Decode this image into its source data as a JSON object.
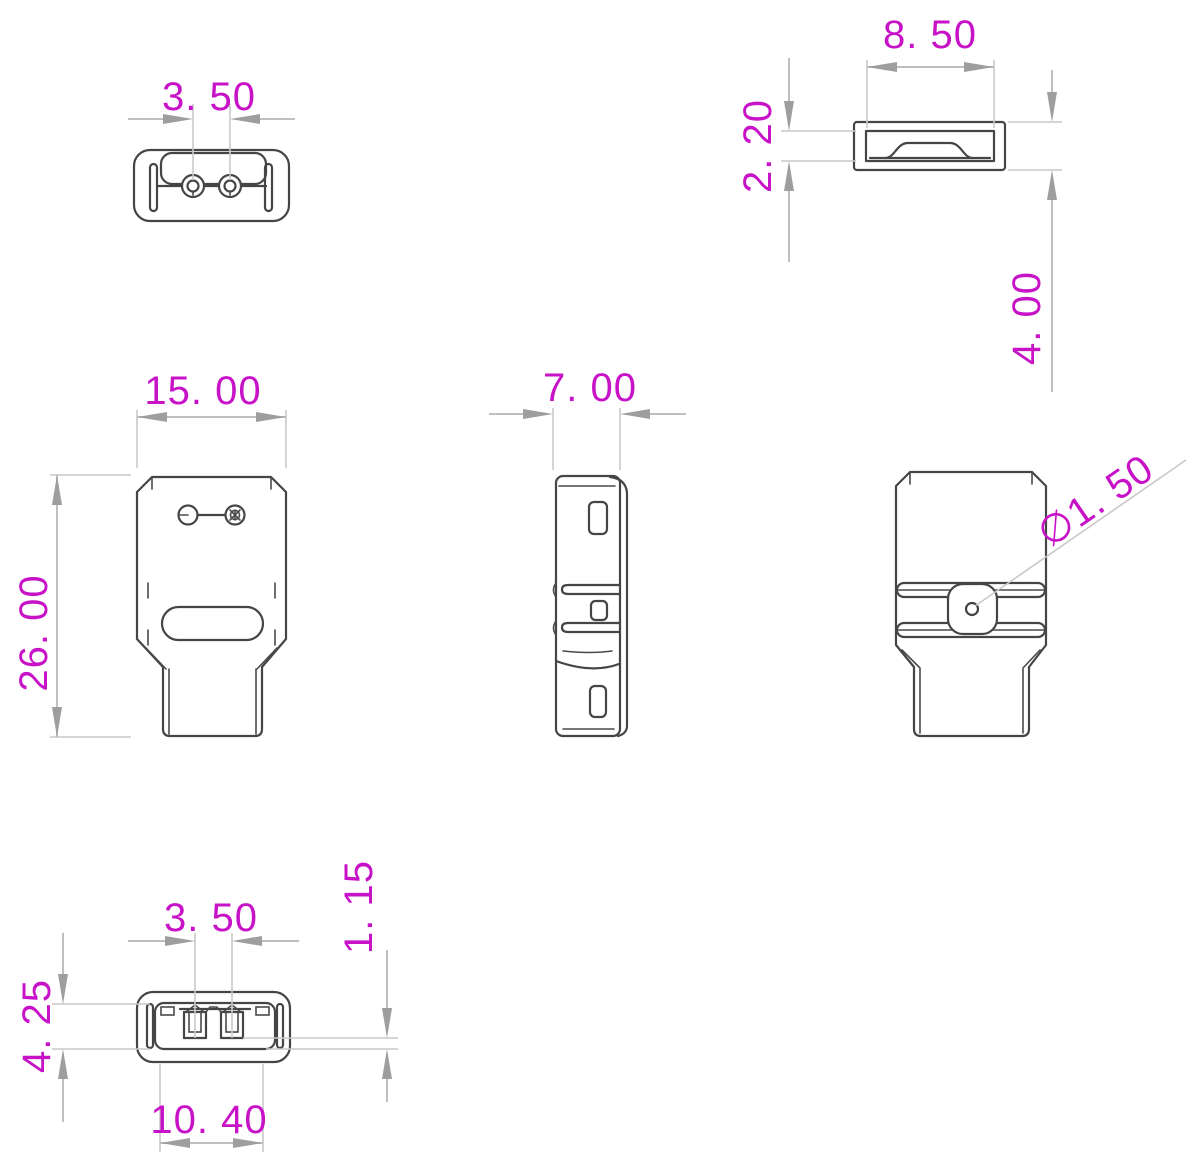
{
  "drawing": {
    "kind": "connector-dimensional-drawing",
    "units_implied": "mm",
    "colors": {
      "dimension_text": "#c712c7",
      "dimension_lines": "#bfbfbf",
      "arrowheads": "#9e9e9e",
      "part_outline": "#454545",
      "background": "#ffffff"
    }
  },
  "views": {
    "top": {
      "label": "top-end-view",
      "dims": {
        "pin_pitch": "3. 50"
      }
    },
    "cap": {
      "label": "cap-section-view",
      "dims": {
        "width": "8. 50",
        "inner_height": "2. 20",
        "outer_height": "4. 00"
      }
    },
    "front": {
      "label": "front-view",
      "dims": {
        "width": "15. 00",
        "height": "26. 00"
      }
    },
    "side": {
      "label": "side-view",
      "dims": {
        "depth": "7. 00"
      }
    },
    "back": {
      "label": "back-view",
      "dims": {
        "hole_diameter": "∅1. 50"
      }
    },
    "bottom": {
      "label": "bottom-view",
      "dims": {
        "pin_pitch": "3. 50",
        "cavity_depth": "4. 25",
        "slot_width": "10. 40",
        "lip_height": "1. 15"
      }
    }
  }
}
